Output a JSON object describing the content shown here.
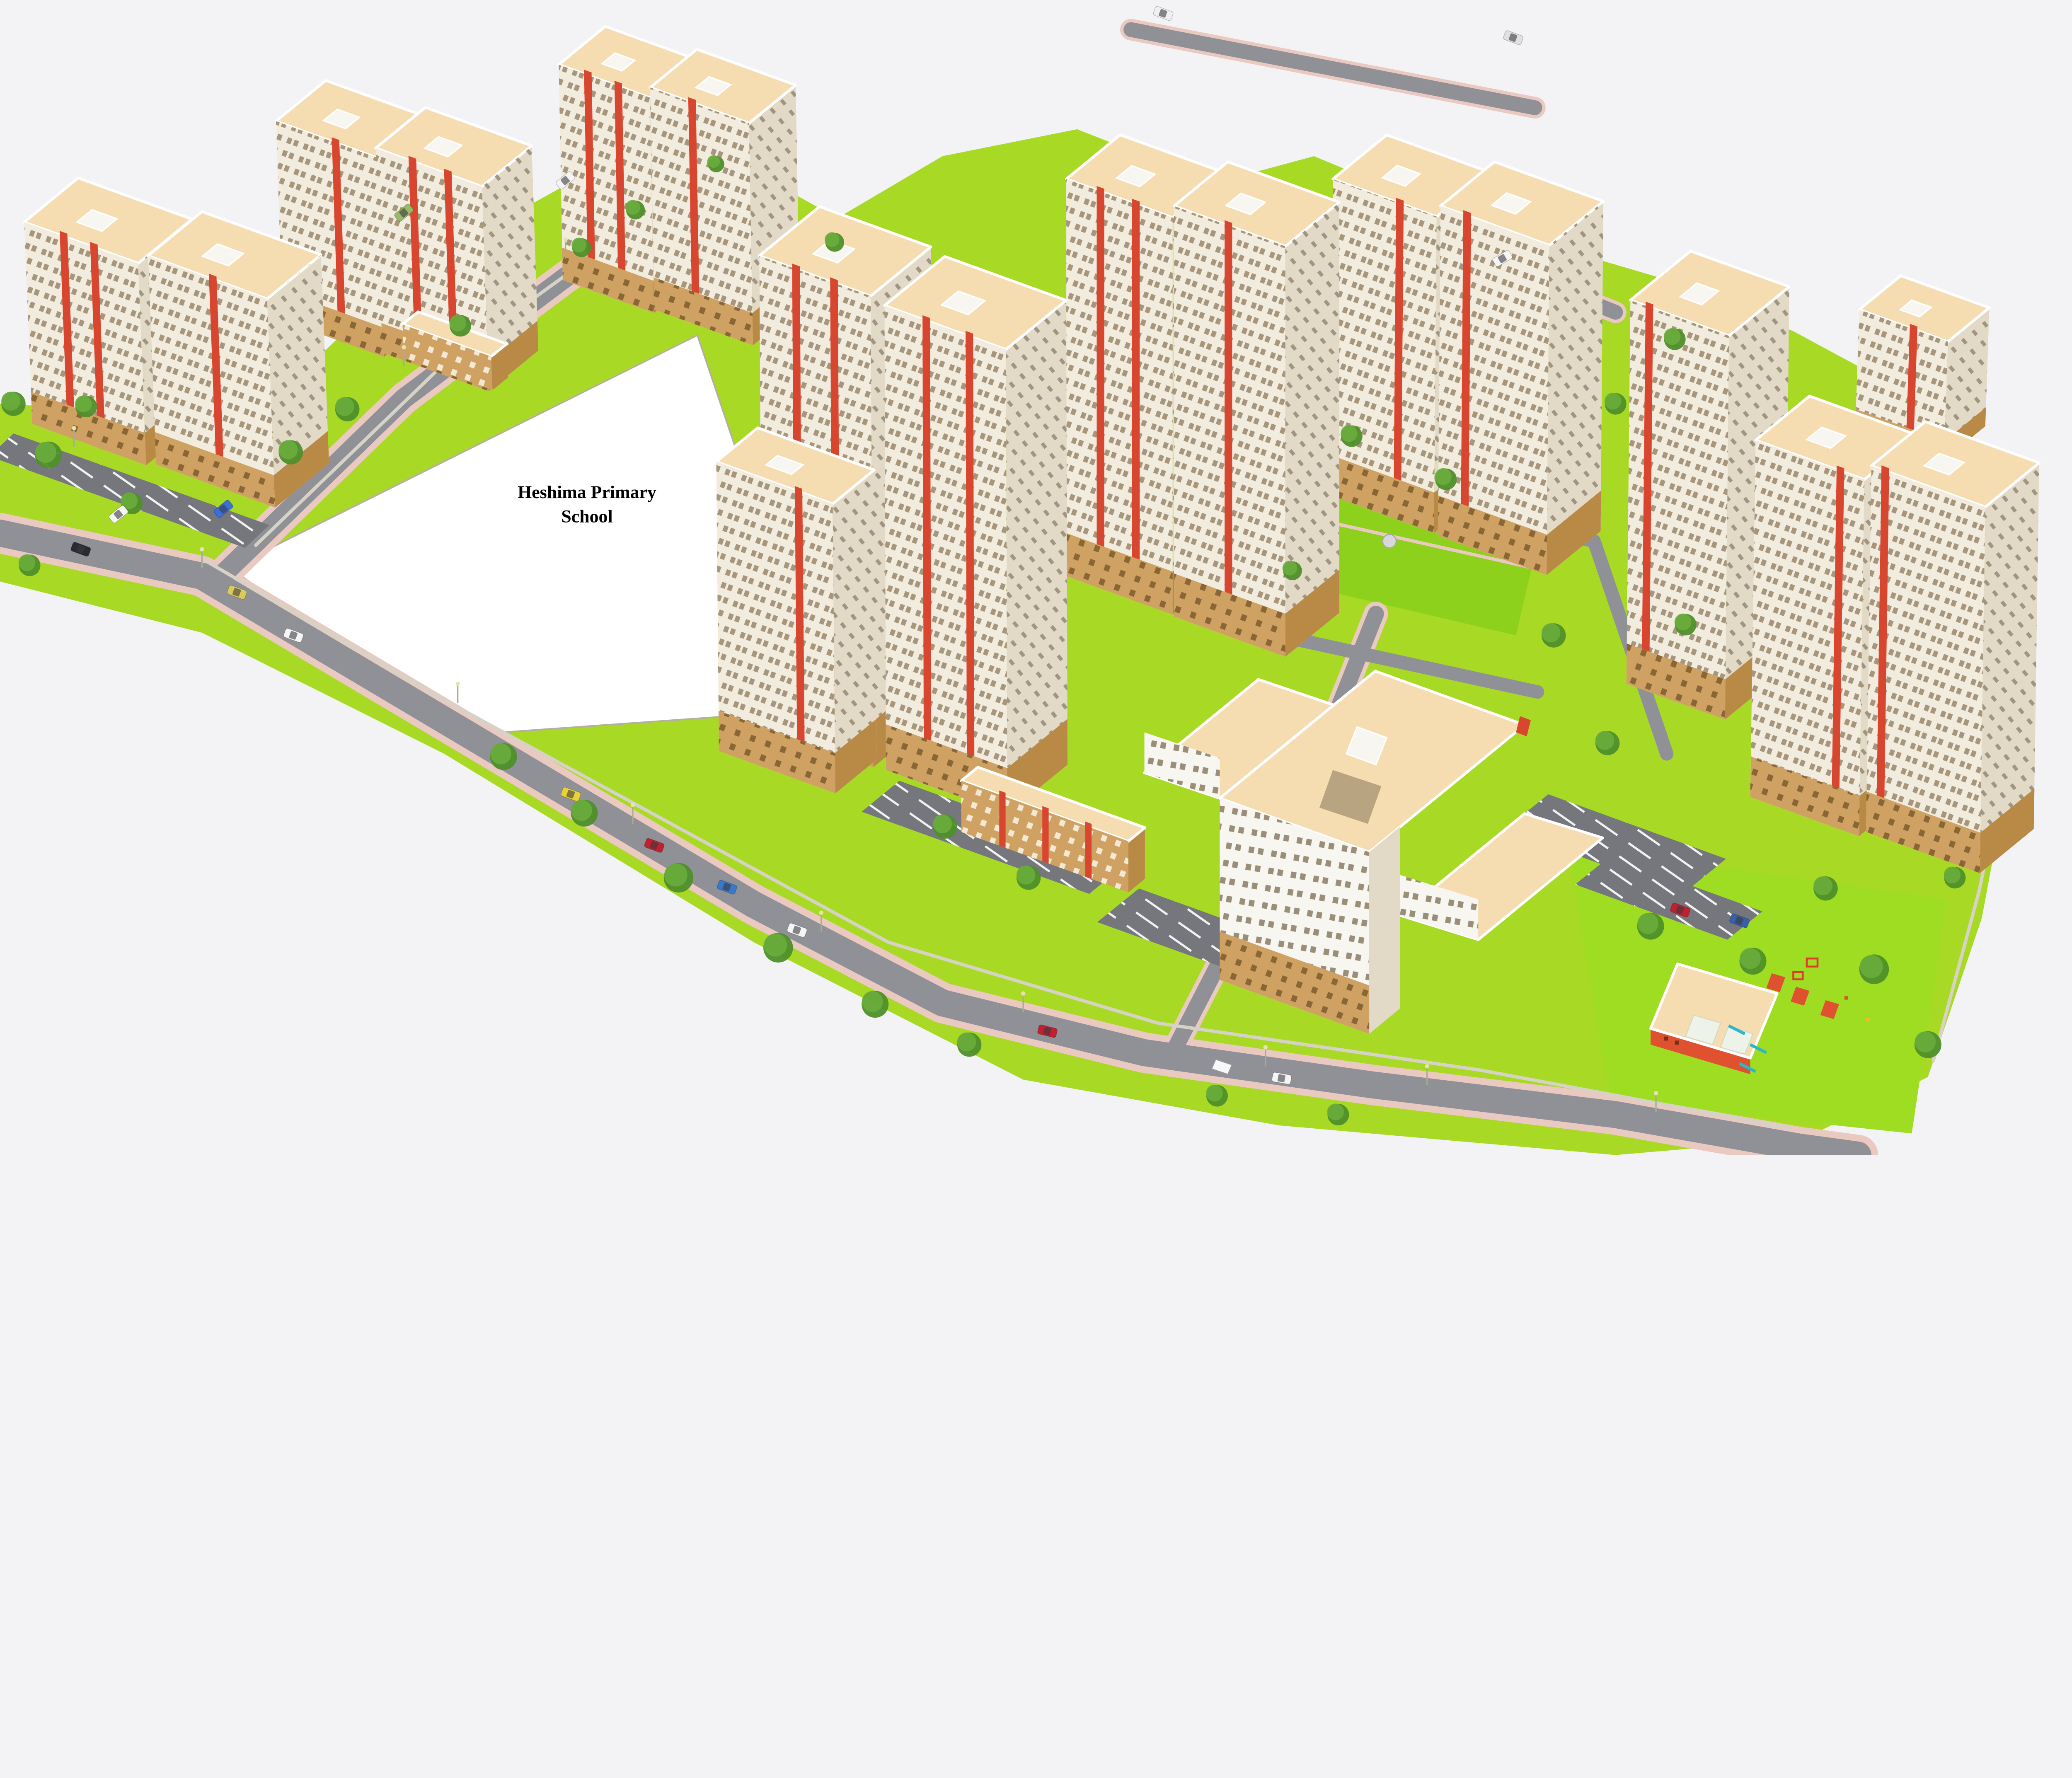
{
  "scene": {
    "type": "architectural-masterplan-3d-render",
    "description": "Aerial 3D rendering of a high-rise residential estate with cream towers, red accent stripes, tan podium floors, internal roads, parking, lawns, playground and a reserved white plot for a school",
    "school_plot_label": {
      "line1": "Heshima Primary",
      "line2": "School"
    }
  },
  "palette": {
    "sky": "#f3f3f6",
    "verge": "#a8da25",
    "lawn": "#8ed11c",
    "playlawn": "#9edd22",
    "road": "#8f9197",
    "parking": "#75777d",
    "sidewalk": "#eac9c1",
    "cream": "#f2ecdf",
    "creamShade": "#e2d9c6",
    "bwhite": "#f7f6f1",
    "red": "#d8462f",
    "tan": "#cfa263",
    "tanShade": "#b98a45",
    "roof": "#f6dcb1",
    "windowTan": "#a7967c",
    "windowDark": "#7d5c2c",
    "windowSide": "#8f8471",
    "windowSparse": "#9b8e79",
    "windowLow": "#f2e8d4",
    "treeG": "#69ab3c",
    "treeD": "#4f8f2a",
    "wall": "#d6d2c6",
    "fence": "#b5afa0",
    "redBuild": "#df512f",
    "playRed": "#e03a2a",
    "playCyan": "#2cb8c6",
    "playYellow": "#efc11e"
  }
}
